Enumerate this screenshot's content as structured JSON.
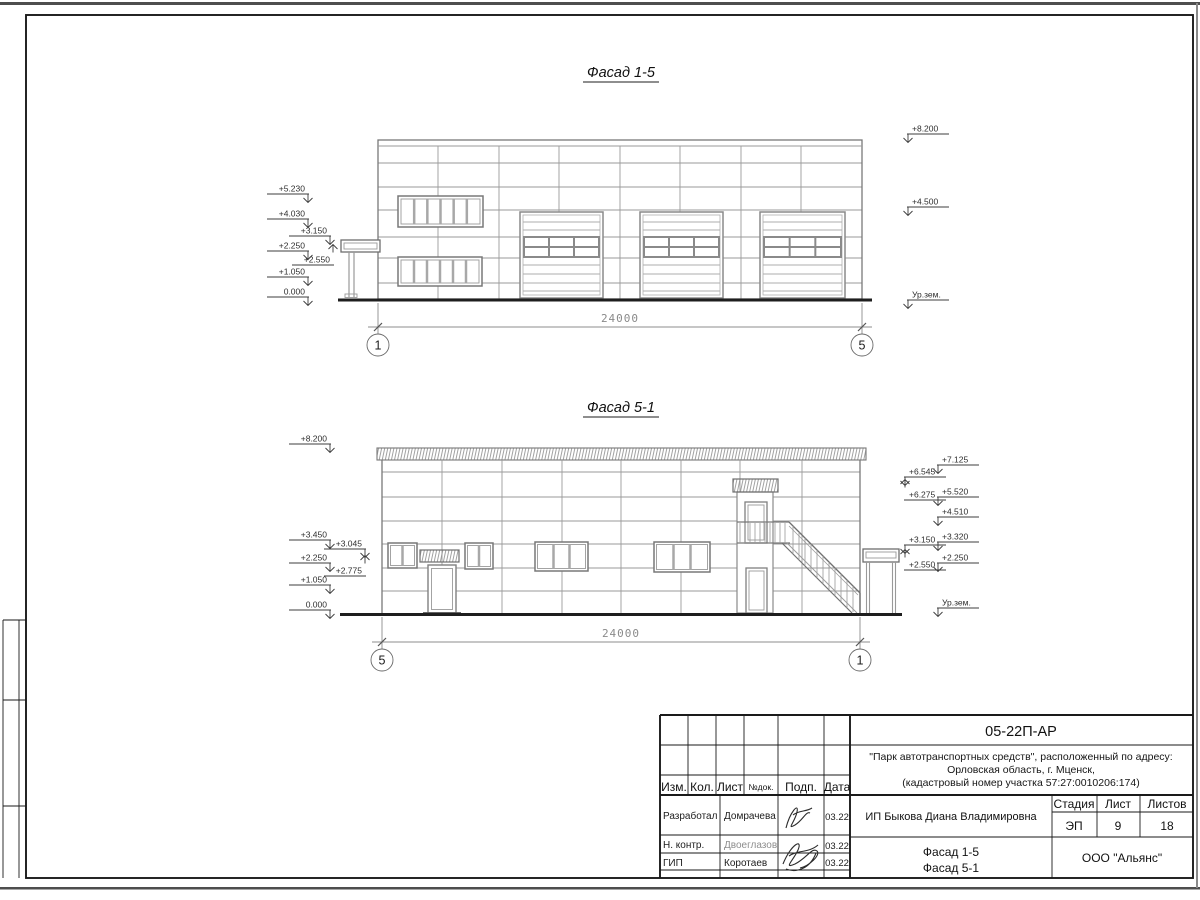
{
  "facade_top": {
    "title": "Фасад 1-5",
    "left_marks": [
      "+5.230",
      "+4.030",
      "+3.150",
      "+2.250",
      "+2.550",
      "+1.050",
      "0.000"
    ],
    "right_marks": [
      "+8.200",
      "+4.500",
      "Ур.зем."
    ],
    "dimension": "24000",
    "axis_left": "1",
    "axis_right": "5"
  },
  "facade_bottom": {
    "title": "Фасад 5-1",
    "left_marks": [
      "+8.200",
      "+3.450",
      "+3.045",
      "+2.250",
      "+2.775",
      "+1.050",
      "0.000"
    ],
    "right_marks_inner": [
      "+6.545",
      "+6.275",
      "+3.150",
      "+2.550"
    ],
    "right_marks_outer": [
      "+7.125",
      "+5.520",
      "+4.510",
      "+3.320",
      "+2.250",
      "Ур.зем."
    ],
    "dimension": "24000",
    "axis_left": "5",
    "axis_right": "1"
  },
  "title_block": {
    "doc_number": "05-22П-АР",
    "project_line1": "\"Парк автотранспортных средств\",  расположенный по адресу:",
    "project_line2": "Орловская область, г. Мценск,",
    "project_line3": "(кадастровый номер участка 57:27:0010206:174)",
    "col_izm": "Изм.",
    "col_kol": "Кол.",
    "col_list": "Лист",
    "col_ndok": "№док.",
    "col_podp": "Подп.",
    "col_data": "Дата",
    "row1_role": "Разработал",
    "row1_name": "Домрачева",
    "row1_date": "03.22",
    "row2_role": "Н. контр.",
    "row2_name": "Двоеглазов",
    "row2_date": "03.22",
    "row3_role": "ГИП",
    "row3_name": "Коротаев",
    "row3_date": "03.22",
    "client": "ИП Быкова Диана Владимировна",
    "stage_label": "Стадия",
    "sheet_label": "Лист",
    "sheets_label": "Листов",
    "stage": "ЭП",
    "sheet_no": "9",
    "sheets_total": "18",
    "drawing_title_line1": "Фасад 1-5",
    "drawing_title_line2": "Фасад 5-1",
    "company": "ООО \"Альянс\""
  }
}
